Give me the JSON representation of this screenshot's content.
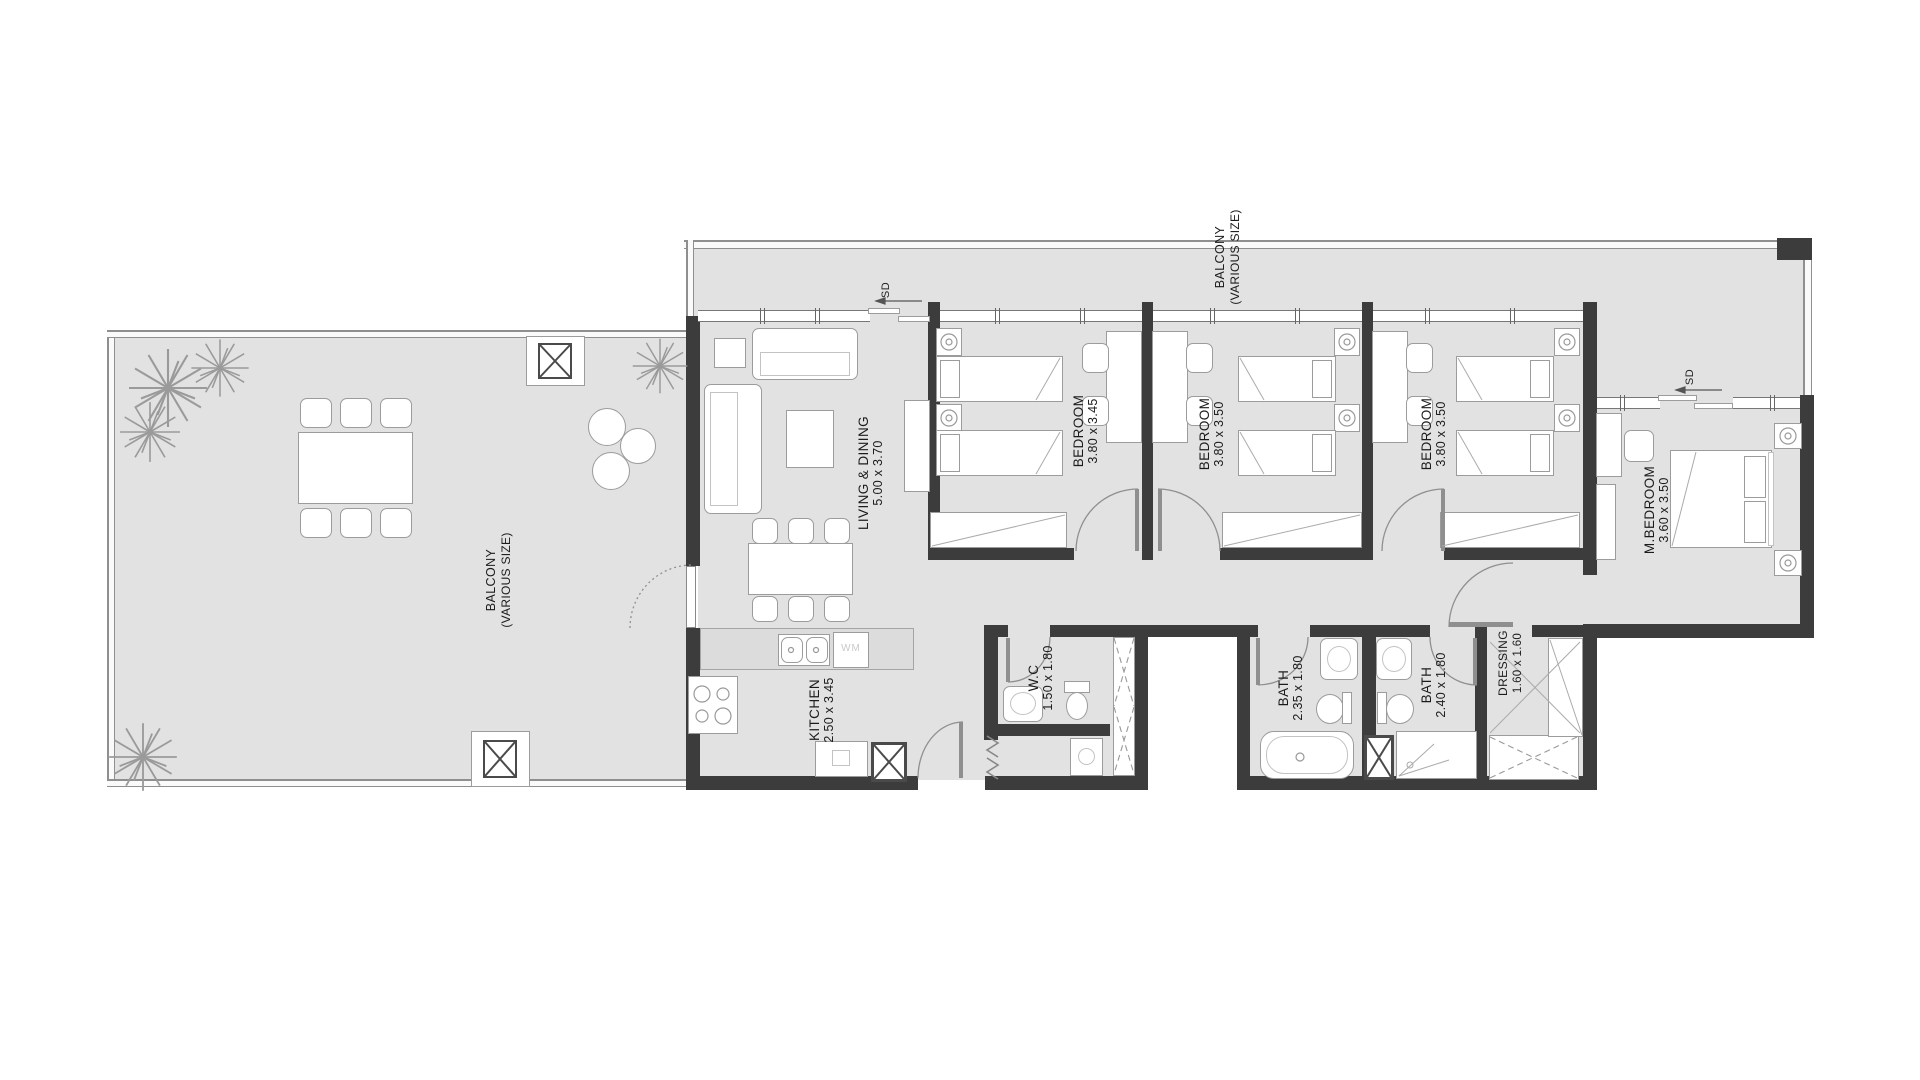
{
  "rooms": {
    "living": {
      "name": "LIVING & DINING",
      "dims": "5.00 x 3.70"
    },
    "bedroom1": {
      "name": "BEDROOM",
      "dims": "3.80 x 3.45"
    },
    "bedroom2": {
      "name": "BEDROOM",
      "dims": "3.80 x 3.50"
    },
    "bedroom3": {
      "name": "BEDROOM",
      "dims": "3.80 x 3.50"
    },
    "master": {
      "name": "M.BEDROOM",
      "dims": "3.60 x 3.50"
    },
    "kitchen": {
      "name": "KITCHEN",
      "dims": "2.50 x 3.45"
    },
    "wc": {
      "name": "W.C",
      "dims": "1.50 x 1.80"
    },
    "bath1": {
      "name": "BATH",
      "dims": "2.35 x 1.80"
    },
    "bath2": {
      "name": "BATH",
      "dims": "2.40 x 1.80"
    },
    "dressing": {
      "name": "DRESSING",
      "dims": "1.60 x 1.60"
    },
    "balcony_left": {
      "name": "BALCONY",
      "dims": "(VARIOUS SIZE)"
    },
    "balcony_top": {
      "name": "BALCONY",
      "dims": "(VARIOUS SIZE)"
    }
  },
  "annotations": {
    "sliding_door": "SD",
    "washer": "WM"
  },
  "colors": {
    "wall": "#3c3c3c",
    "floor": "#e2e2e2",
    "counter": "#dcdcdc",
    "line": "#9c9c9c",
    "label": "#1b1b1b",
    "background": "#ffffff"
  }
}
